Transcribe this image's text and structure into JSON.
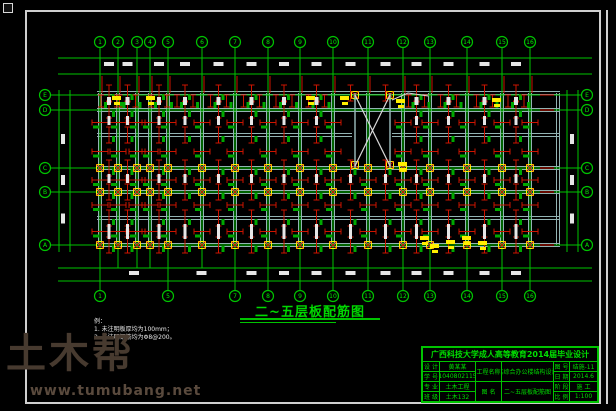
{
  "colors": {
    "green": "#00c400",
    "green_bright": "#00e800",
    "red": "#cc1500",
    "yellow": "#ffee00",
    "beam": "#93b3b3",
    "white": "#e6e6e6",
    "mark_green": "#00a800"
  },
  "title": {
    "text": "二~五层板配筋图"
  },
  "axes": {
    "top_labels": [
      "1",
      "2",
      "3",
      "4",
      "5",
      "6",
      "7",
      "8",
      "9",
      "10",
      "11",
      "12",
      "13",
      "14",
      "15",
      "16"
    ],
    "bottom_labels": [
      "1",
      "5",
      "7",
      "8",
      "9",
      "10",
      "11",
      "12",
      "13",
      "14",
      "15",
      "16"
    ],
    "left_labels": [
      "E",
      "D",
      "C",
      "B",
      "A"
    ],
    "right_labels": [
      "E",
      "D",
      "C",
      "B",
      "A"
    ]
  },
  "notes": {
    "heading": "例：",
    "items": [
      "1. 未注明板厚均为100mm；",
      "2. 未注明钢筋均为Φ8@200。"
    ]
  },
  "watermark": {
    "logo": "土木帮",
    "url": "www.tumubang.net"
  },
  "titleblock": {
    "banner": "广西科技大学成人高等教育2014届毕业设计",
    "cells": {
      "l1": "设 计",
      "v1": "黄某某",
      "l2": "学 号",
      "v2": "1040802115",
      "l3": "专 业",
      "v3": "土木工程",
      "l4": "班 级",
      "v4": "土木132",
      "pl": "工程名称",
      "pv": "某综合办公楼结构设计",
      "dl": "图 名",
      "dv": "二~五层板配筋图",
      "r1": "图 号",
      "rv1": "结施-11",
      "r2": "日 期",
      "rv2": "2014.6",
      "r3": "阶 段",
      "rv3": "施 工",
      "r4": "比 例",
      "rv4": "1:100"
    }
  }
}
